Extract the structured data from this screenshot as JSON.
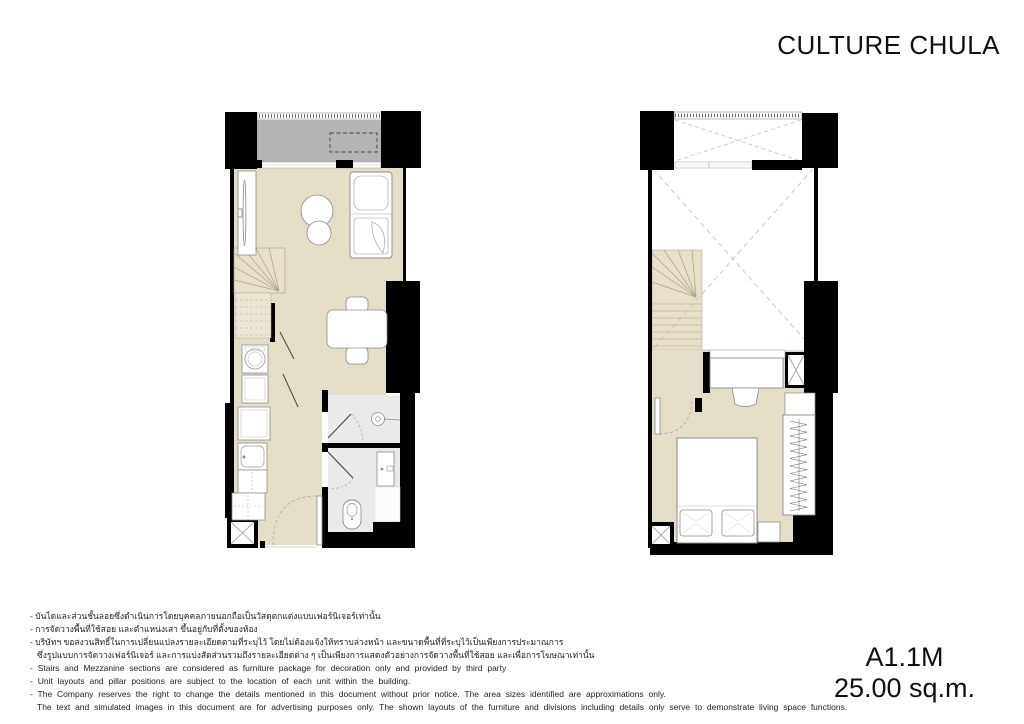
{
  "header": {
    "brand": "CULTURE CHULA"
  },
  "unit": {
    "code": "A1.1M",
    "area": "25.00 sq.m."
  },
  "disclaimer": {
    "lines": [
      "- บันไดและส่วนชั้นลอยซึ่งดำเนินการโดยบุคคลภายนอกถือเป็นวัสดุตกแต่งแบบเฟอร์นิเจอร์เท่านั้น",
      "- การจัดวางพื้นที่ใช้สอย และตำแหน่งเสา ขึ้นอยู่กับที่ตั้งของห้อง",
      "- บริษัทฯ ขอสงวนสิทธิ์ในการเปลี่ยนแปลงรายละเอียดตามที่ระบุไว้ โดยไม่ต้องแจ้งให้ทราบล่วงหน้า และขนาดพื้นที่ที่ระบุไว้เป็นเพียงการประมาณการ",
      "ซึ่งรูปแบบการจัดวางเฟอร์นิเจอร์ และการแบ่งสัดส่วนรวมถึงรายละเอียดต่าง ๆ เป็นเพียงการแสดงตัวอย่างการจัดวางพื้นที่ใช้สอย และเพื่อการโฆษณาเท่านั้น",
      "- Stairs and Mezzanine sections are considered as furniture package for decoration only and provided by third party",
      "- Unit layouts and pillar positions are subject to the location of each unit within the building.",
      "- The Company reserves the right to change the details mentioned in this document without prior notice. The area sizes identified are approximations only.",
      "The text and simulated images in this document are for advertising purposes only. The shown layouts of the furniture and divisions including details only serve to demonstrate living space functions."
    ]
  },
  "colors": {
    "wall": "#000000",
    "floor": "#e4ddc8",
    "stairs": "#e7dfca",
    "balcony": "#b4b4b4",
    "bathroom": "#eaeae8",
    "furniture_outline": "#8c8c8c",
    "text": "#1a1a1a"
  }
}
